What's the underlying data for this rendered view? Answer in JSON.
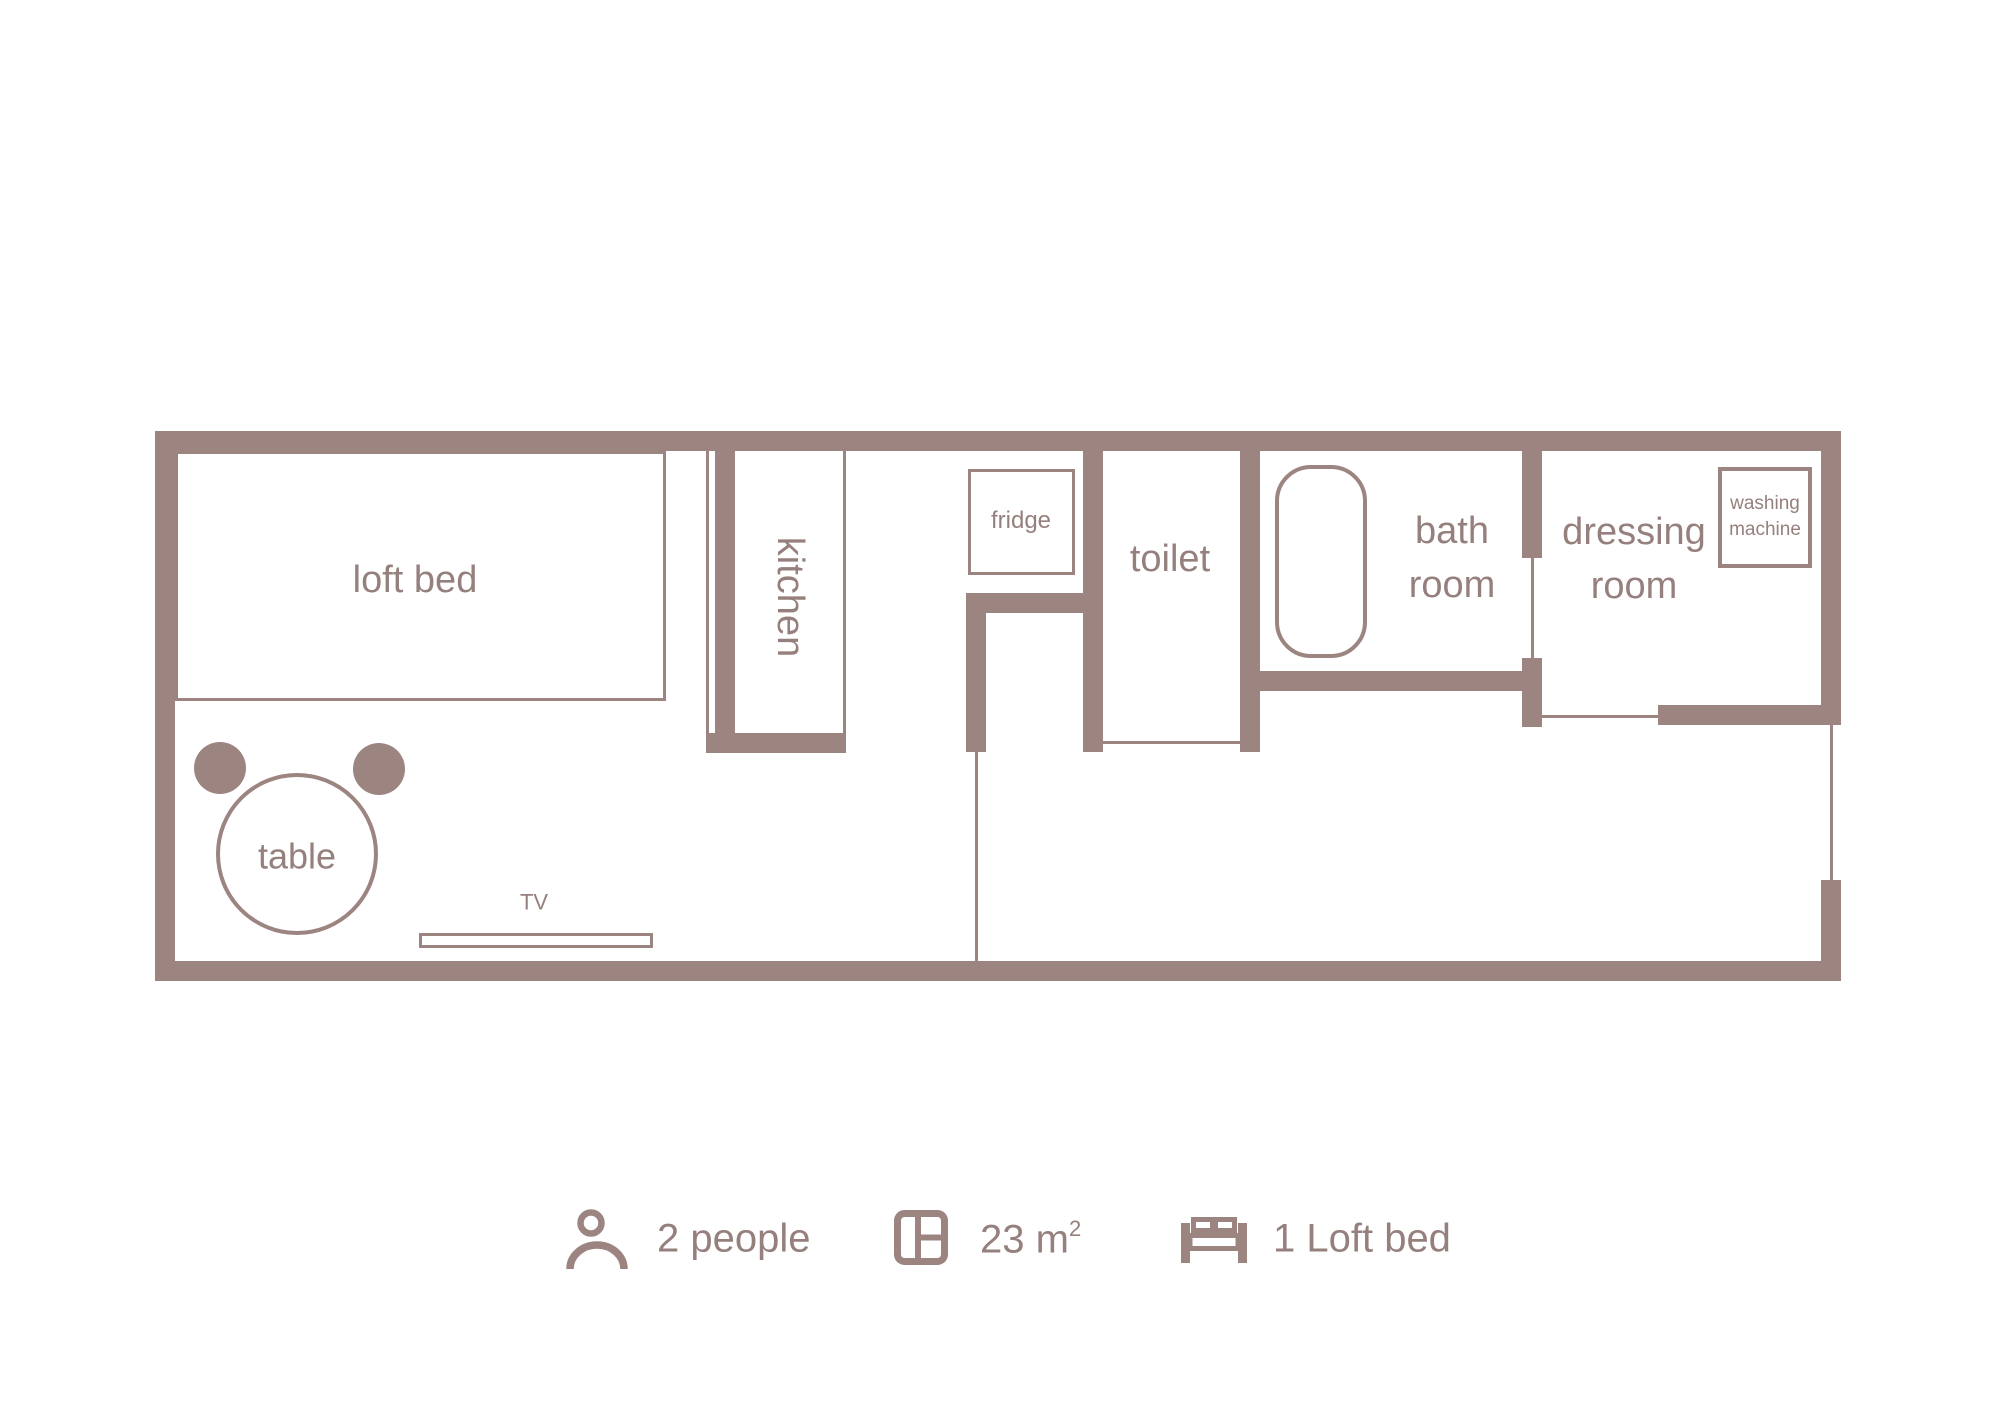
{
  "colors": {
    "wall": "#9c8481",
    "text": "#95807d",
    "background": "#ffffff"
  },
  "plan": {
    "loft_bed_label": "loft bed",
    "kitchen_label": "kitchen",
    "fridge_label": "fridge",
    "toilet_label": "toilet",
    "bath_room": {
      "line1": "bath",
      "line2": "room"
    },
    "dressing_room": {
      "line1": "dressing",
      "line2": "room"
    },
    "washing_machine": {
      "line1": "washing",
      "line2": "machine"
    },
    "table_label": "table",
    "tv_label": "TV"
  },
  "legend": {
    "occupancy": {
      "icon": "person-icon",
      "label": "2 people"
    },
    "area": {
      "icon": "window-icon",
      "value": "23 m",
      "sup": "2"
    },
    "bed": {
      "icon": "bed-icon",
      "label": "1 Loft bed"
    }
  }
}
